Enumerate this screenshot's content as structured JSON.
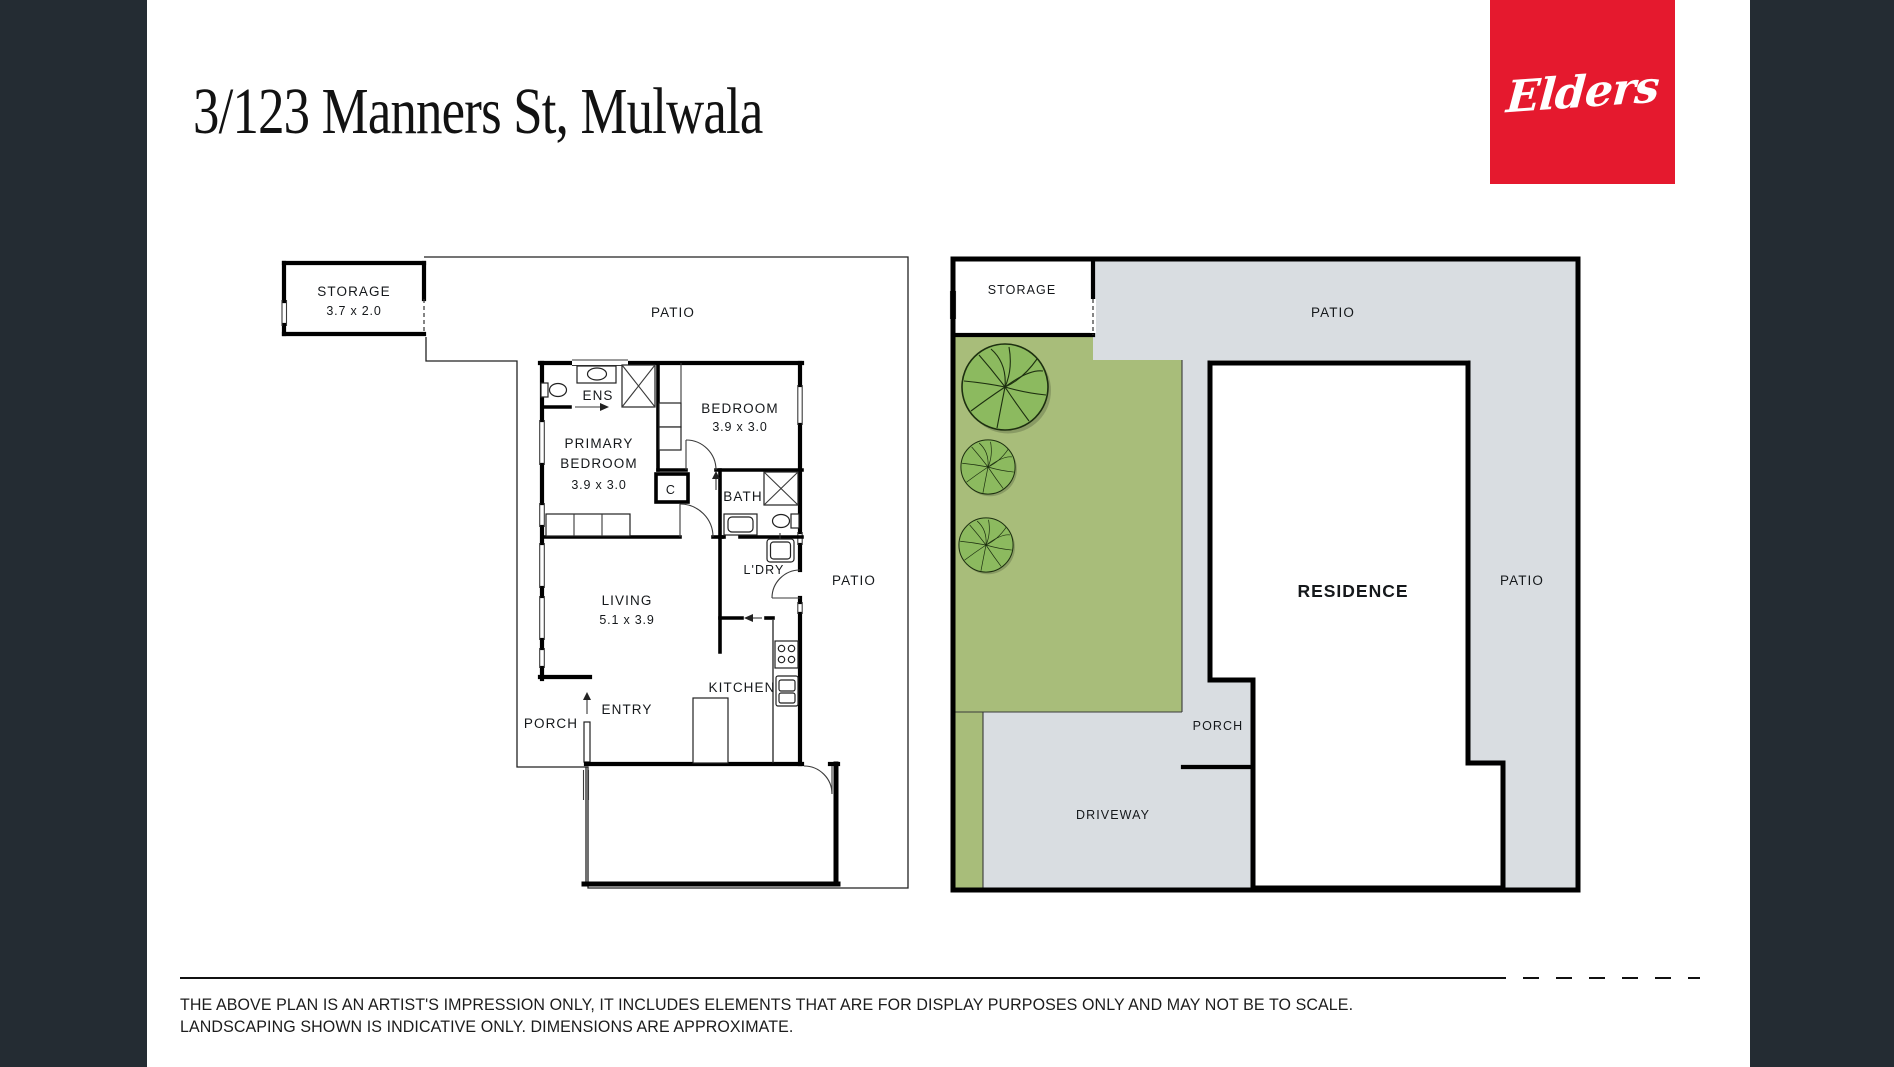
{
  "header": {
    "title": "3/123 Manners St, Mulwala"
  },
  "logo": {
    "text": "Elders",
    "bg_color": "#e5192e",
    "text_color": "#ffffff"
  },
  "page": {
    "background": "#ffffff",
    "side_strip_color": "#242c33"
  },
  "left_plan": {
    "storage": {
      "name": "STORAGE",
      "dim": "3.7 x 2.0"
    },
    "patio_top": "PATIO",
    "ens": "ENS",
    "bedroom": {
      "name": "BEDROOM",
      "dim": "3.9 x 3.0"
    },
    "primary_bedroom": {
      "line1": "PRIMARY",
      "line2": "BEDROOM",
      "dim": "3.9 x 3.0"
    },
    "closet": "C",
    "bath": "BATH",
    "laundry": "L'DRY",
    "patio_right": "PATIO",
    "living": {
      "name": "LIVING",
      "dim": "5.1 x 3.9"
    },
    "kitchen": "KITCHEN",
    "entry": "ENTRY",
    "porch": "PORCH"
  },
  "right_plan": {
    "storage": "STORAGE",
    "patio_top": "PATIO",
    "patio_right": "PATIO",
    "residence": "RESIDENCE",
    "porch": "PORCH",
    "driveway": "DRIVEWAY",
    "colors": {
      "grass": "#a8bd7a",
      "paving": "#d9dde1",
      "tree": "#8cba5f",
      "tree_vein": "#1d2f10"
    }
  },
  "disclaimer": {
    "line1": "THE ABOVE PLAN IS AN ARTIST'S IMPRESSION ONLY, IT INCLUDES ELEMENTS THAT ARE FOR DISPLAY PURPOSES ONLY AND MAY NOT BE TO SCALE.",
    "line2": "LANDSCAPING SHOWN IS INDICATIVE ONLY. DIMENSIONS ARE APPROXIMATE."
  }
}
